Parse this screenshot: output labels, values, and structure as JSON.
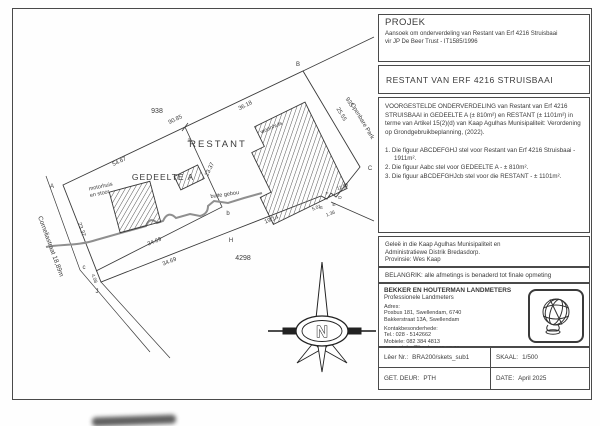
{
  "panel": {
    "projek": {
      "heading": "PROJEK",
      "line1": "Aansoek om onderverdeling van Restant van Erf 4216 Struisbaai",
      "line2": "vir JP De Beer Trust - IT1585/1996"
    },
    "title": "RESTANT VAN ERF 4216 STRUISBAAI",
    "proposal": "VOORGESTELDE ONDERVERDELING van Restant van Erf 4216 STRUISBAAI in GEDEELTE A (± 810m²) en RESTANT (± 1101m²) in terme van Artikel 15(2)(d) van Kaap Agulhas Munisipaliteit: Verordening op Grondgebruikbeplanning, (2022).",
    "figures": [
      "1. Die figuur ABCDEFGHJ stel voor Restant van Erf 4216 Struisbaai - 1911m².",
      "2. Die figuur Aabc stel voor GEDEELTE A - ± 810m².",
      "3. Die figuur aBCDEFGHJcb stel voor die RESTANT - ± 1101m²."
    ],
    "location_line1": "Geleë in die Kaap Agulhas Munisipaliteit en",
    "location_line2": "Administratiewe Distrik Bredasdorp.",
    "location_line3": "Provinsie:  Wes Kaap",
    "important": "BELANGRIK:  alle afmetings is benaderd tot finale opmeting",
    "surveyor": {
      "name": "BEKKER EN HOUTERMAN LANDMETERS",
      "subtitle": "Professionele Landmeters",
      "address_label": "Adres:",
      "address1": "Posbus 181, Swellendam, 6740",
      "address2": "Bakkerstraat 13A, Swellendam",
      "contact_label": "Kontakbesonderhede:",
      "tel": "Tel.:  028 - 5142662",
      "mobile": "Mobiele:  082 384 4813",
      "email": "epos:  pieter@houterman.co.za"
    },
    "footer": {
      "file_label": "Lêer Nr.:",
      "file_value": "BRA200/skets_sub1",
      "scale_label": "SKAAL:",
      "scale_value": "1/500",
      "drawn_label": "GET. DEUR:",
      "drawn_value": "PTH",
      "date_label": "DATE:",
      "date_value": "April 2025"
    }
  },
  "plan": {
    "erven": {
      "left": "938",
      "right": "935",
      "park": "Openbare Park",
      "bottom": "4298"
    },
    "parcels": {
      "restant": "RESTANT",
      "gedeelte_a": "GEDEELTE A"
    },
    "street": "Corneliastraat 18,89m",
    "buildings": {
      "woonhuis": "woonhuis",
      "buite_gebou": "buite gebou",
      "motorhuis_line1": "motorhuis",
      "motorhuis_line2": "en stoor"
    },
    "dims": {
      "ab_total": "90.85",
      "a_seg": "54.67",
      "b_seg": "36.18",
      "east": "25.55",
      "div_ab": "23.37",
      "west": "23.37",
      "div_bc": "34.69",
      "south": "34.69",
      "gh": "19.14",
      "d1": "11.88",
      "d2": "5.01",
      "d3": "1.36",
      "cj": "4.08"
    },
    "corners": {
      "A": "A",
      "B": "B",
      "C": "C",
      "D": "D",
      "E": "E",
      "F": "F",
      "G": "G",
      "H": "H",
      "J": "J",
      "a": "a",
      "b": "b",
      "c": "c"
    },
    "north": "N"
  }
}
